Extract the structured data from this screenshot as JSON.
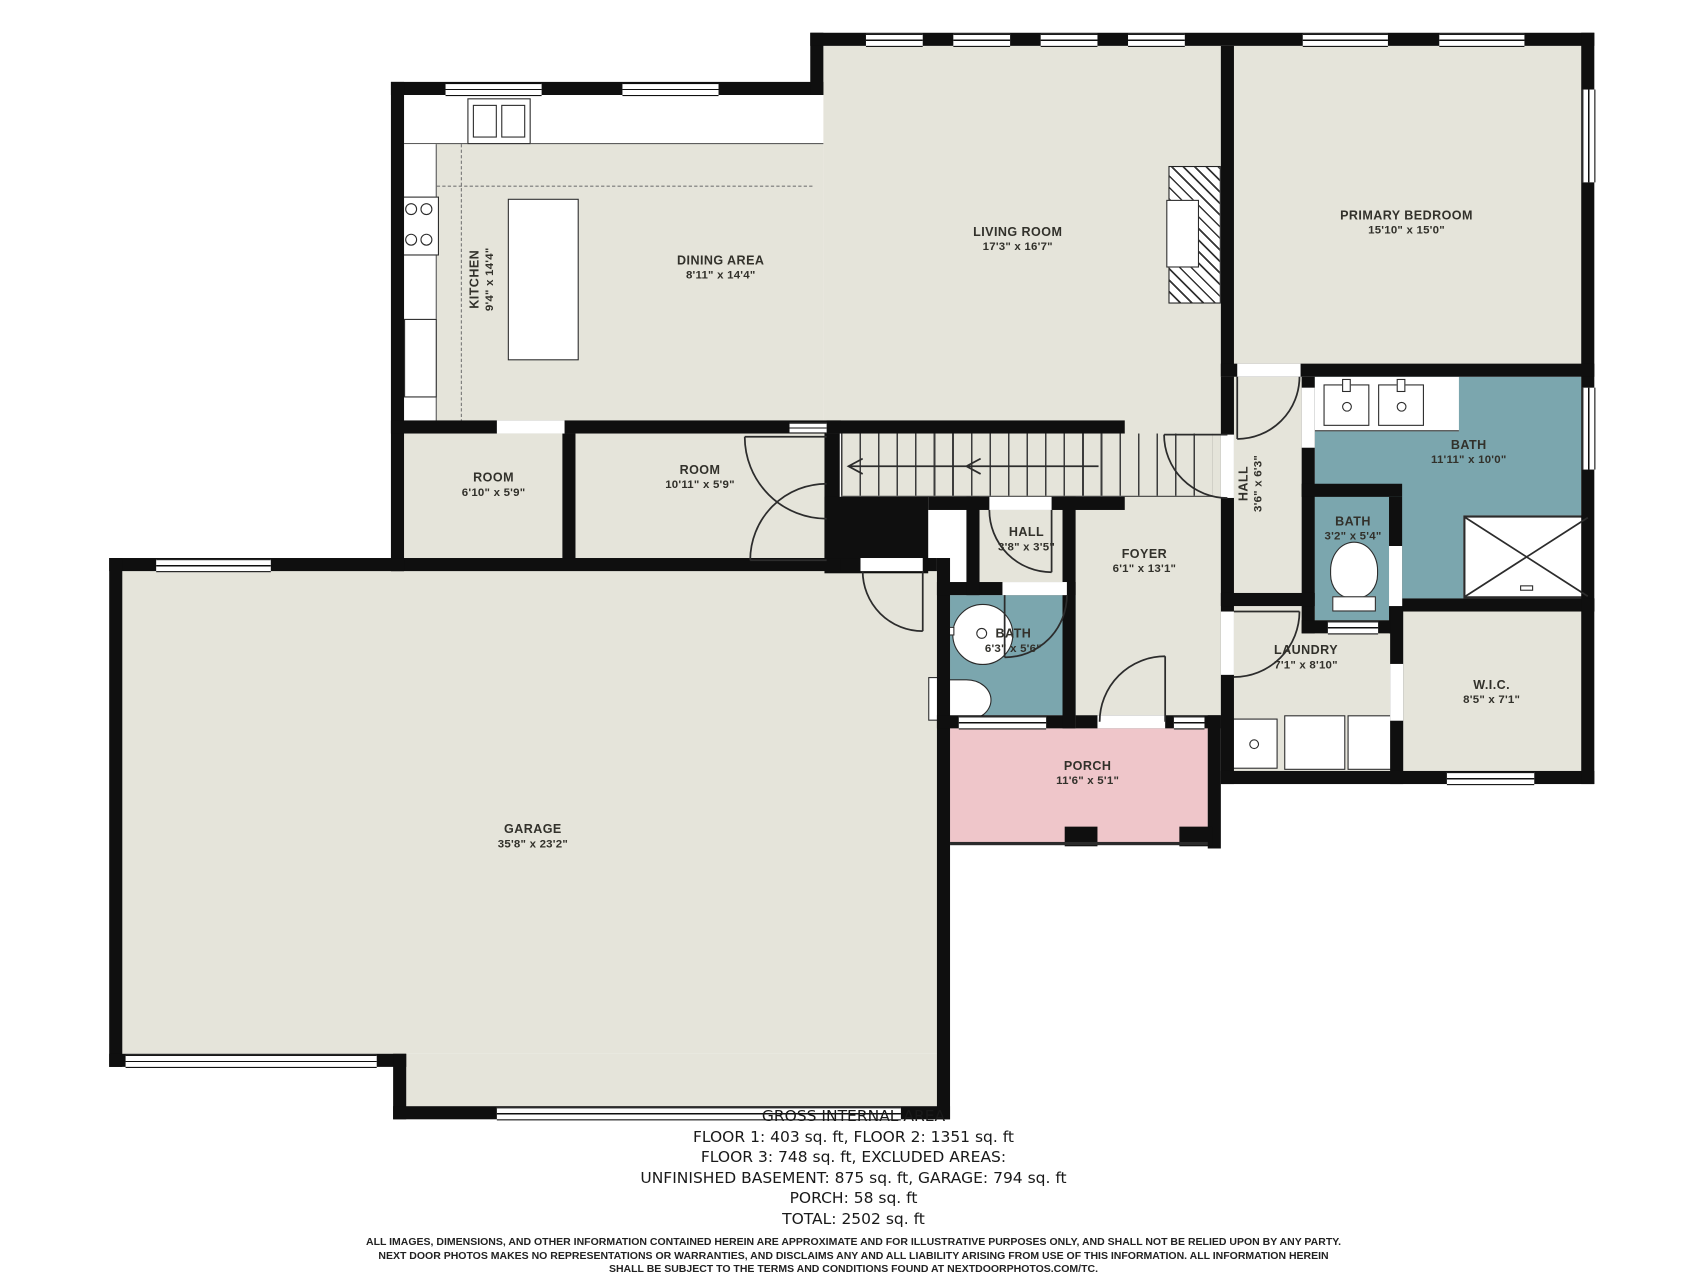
{
  "plan": {
    "rooms": [
      {
        "id": "kitchen",
        "name": "KITCHEN",
        "dims": "9'4\" x 14'4\""
      },
      {
        "id": "dining",
        "name": "DINING AREA",
        "dims": "8'11\" x 14'4\""
      },
      {
        "id": "living",
        "name": "LIVING ROOM",
        "dims": "17'3\" x 16'7\""
      },
      {
        "id": "primary-bedroom",
        "name": "PRIMARY BEDROOM",
        "dims": "15'10\" x 15'0\""
      },
      {
        "id": "room-1",
        "name": "ROOM",
        "dims": "6'10\" x 5'9\""
      },
      {
        "id": "room-2",
        "name": "ROOM",
        "dims": "10'11\" x 5'9\""
      },
      {
        "id": "hall-small",
        "name": "HALL",
        "dims": "3'8\" x 3'5\""
      },
      {
        "id": "foyer",
        "name": "FOYER",
        "dims": "6'1\" x 13'1\""
      },
      {
        "id": "bath-main",
        "name": "BATH",
        "dims": "6'3\" x 5'6\""
      },
      {
        "id": "hall-vertical",
        "name": "HALL",
        "dims": "3'6\" x 6'3\""
      },
      {
        "id": "bath-primary",
        "name": "BATH",
        "dims": "11'11\" x 10'0\""
      },
      {
        "id": "bath-small",
        "name": "BATH",
        "dims": "3'2\" x 5'4\""
      },
      {
        "id": "laundry",
        "name": "LAUNDRY",
        "dims": "7'1\" x 8'10\""
      },
      {
        "id": "wic",
        "name": "W.I.C.",
        "dims": "8'5\" x 7'1\""
      },
      {
        "id": "garage",
        "name": "GARAGE",
        "dims": "35'8\" x 23'2\""
      },
      {
        "id": "porch",
        "name": "PORCH",
        "dims": "11'6\" x 5'1\""
      }
    ]
  },
  "summary": {
    "title": "GROSS INTERNAL AREA",
    "lines": [
      "FLOOR 1: 403 sq. ft, FLOOR 2: 1351 sq. ft",
      "FLOOR 3: 748 sq. ft, EXCLUDED AREAS:",
      "UNFINISHED BASEMENT: 875 sq. ft, GARAGE: 794 sq. ft",
      "PORCH: 58 sq. ft",
      "TOTAL: 2502 sq. ft"
    ]
  },
  "disclaimer": {
    "lines": [
      "ALL IMAGES, DIMENSIONS, AND OTHER INFORMATION CONTAINED HEREIN ARE APPROXIMATE AND FOR ILLUSTRATIVE PURPOSES ONLY, AND SHALL NOT BE RELIED UPON BY ANY PARTY.",
      "NEXT DOOR PHOTOS MAKES NO REPRESENTATIONS OR WARRANTIES, AND DISCLAIMS ANY AND ALL LIABILITY ARISING FROM USE OF THIS INFORMATION. ALL INFORMATION HEREIN",
      "SHALL BE SUBJECT TO THE TERMS AND CONDITIONS FOUND AT NEXTDOORPHOTOS.COM/TC."
    ]
  },
  "colors": {
    "floor": "#e5e4da",
    "bath": "#7ba6ae",
    "porch": "#efc6ca",
    "wall": "#0f0f0f"
  }
}
